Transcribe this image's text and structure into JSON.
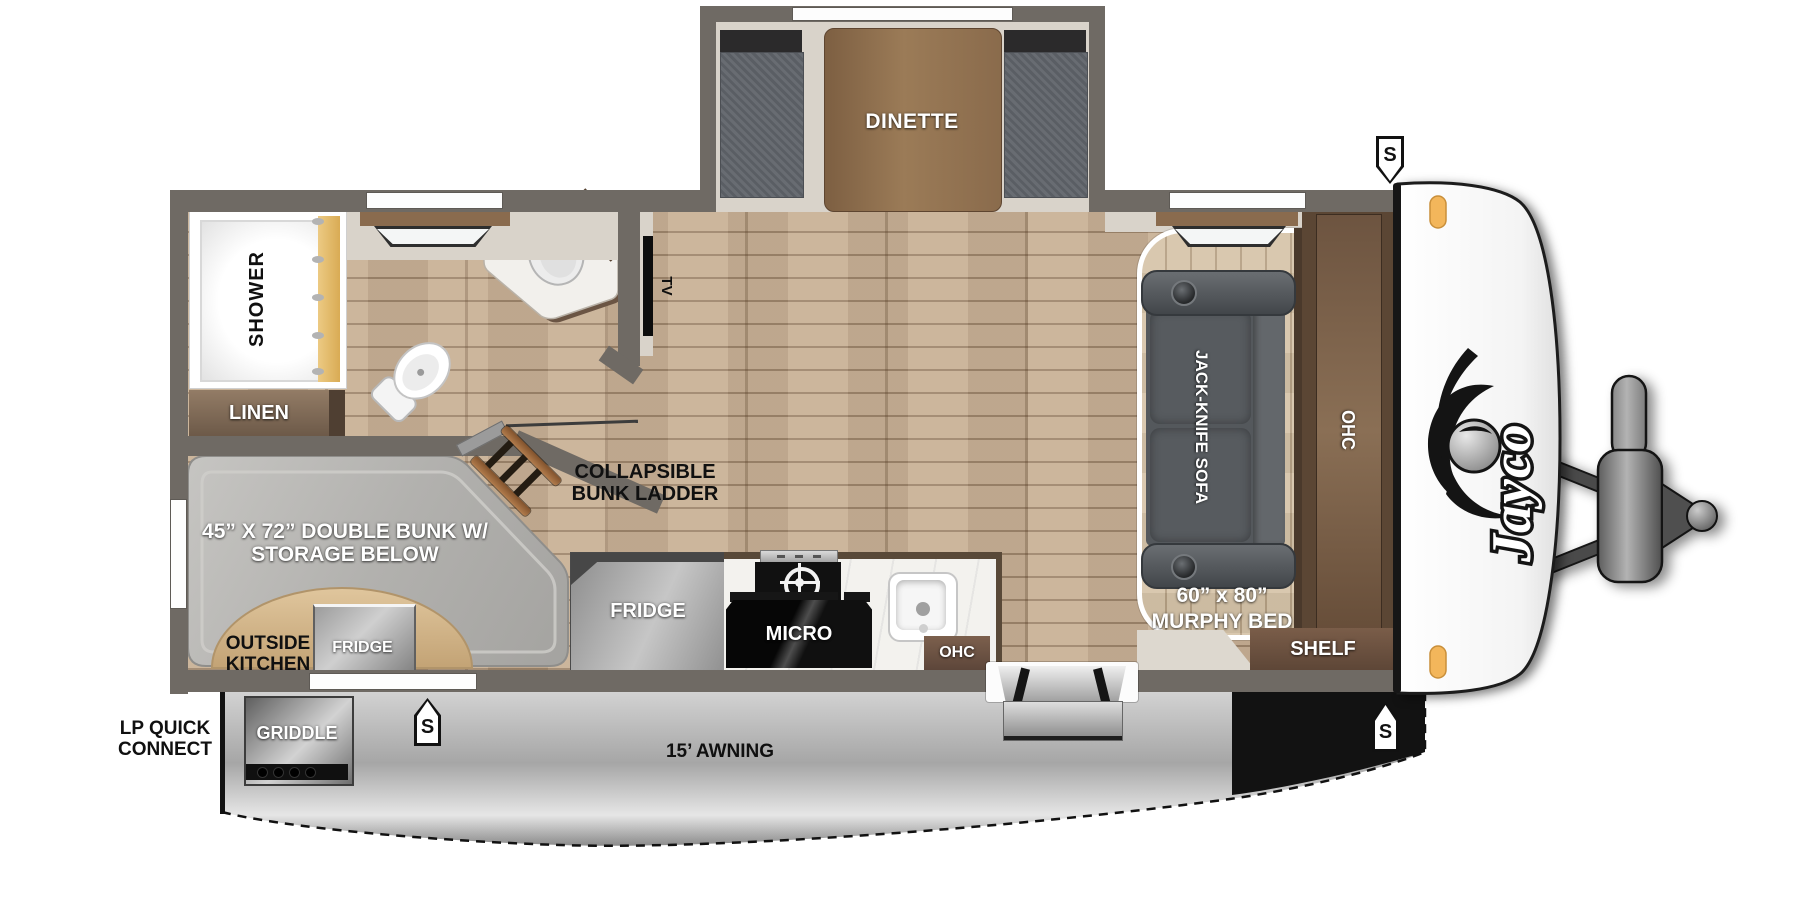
{
  "brand_logo": "Jayco",
  "badges": {
    "solar": "S"
  },
  "rooms": {
    "dinette": "DINETTE",
    "shower": "SHOWER",
    "linen": "LINEN",
    "med_cabinet": "MED",
    "tv": "TV",
    "jack_knife_sofa": "JACK-KNIFE SOFA",
    "murphy_bed_size": "60” x 80”",
    "murphy_bed": "MURPHY BED",
    "ohc_bedroom": "OHC",
    "shelf": "SHELF",
    "bunk_ladder_line1": "COLLAPSIBLE",
    "bunk_ladder_line2": "BUNK LADDER",
    "bunk_line1": "45” X 72” DOUBLE BUNK W/",
    "bunk_line2": "STORAGE BELOW",
    "outside_kitchen_line1": "OUTSIDE",
    "outside_kitchen_line2": "KITCHEN",
    "outside_fridge": "FRIDGE",
    "fridge": "FRIDGE",
    "micro": "MICRO",
    "ohc_kitchen": "OHC"
  },
  "exterior": {
    "griddle": "GRIDDLE",
    "lp_line1": "LP QUICK",
    "lp_line2": "CONNECT",
    "awning": "15’ AWNING"
  },
  "colors": {
    "wall": "#6f6a64",
    "floor_wood": "#c8b095",
    "platform_wood": "#d7c5aa",
    "interior_trim": "#d9d3ca",
    "cabinet_brown": "#75594a",
    "sofa_gray": "#54585c",
    "marker_light_amber": "#f3b65b",
    "awning_silver": "#b8b8b8",
    "curtain_gold": "#ddb362"
  }
}
